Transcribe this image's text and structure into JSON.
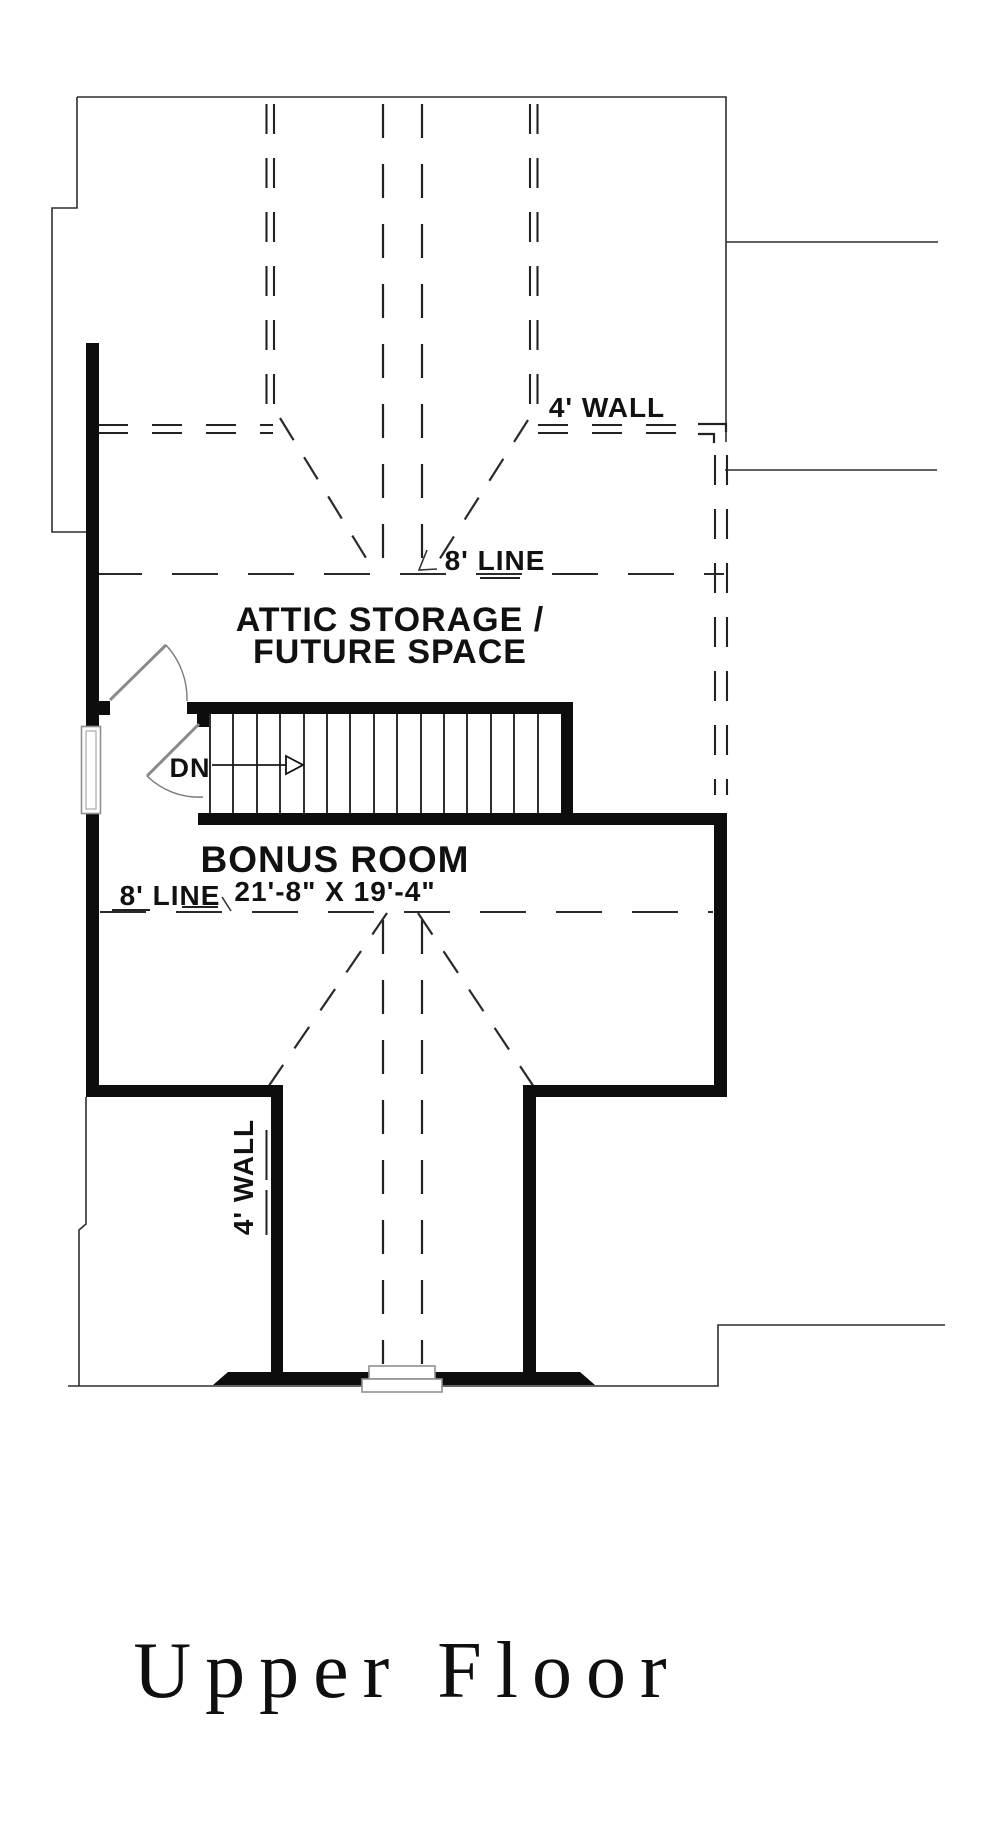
{
  "drawing": {
    "title": "Upper Floor",
    "rooms": {
      "attic_line1": "ATTIC STORAGE /",
      "attic_line2": "FUTURE SPACE",
      "bonus_name": "BONUS ROOM",
      "bonus_dims": "21'-8\" X 19'-4\""
    },
    "annotations": {
      "wall4": "4' WALL",
      "line8": "8' LINE",
      "stair_direction": "DN"
    },
    "colors": {
      "ink": "#111111",
      "thin_line": "#2e2e2e",
      "dashed_line": "#222222",
      "window": "#8f8f8f",
      "background": "#ffffff"
    }
  }
}
